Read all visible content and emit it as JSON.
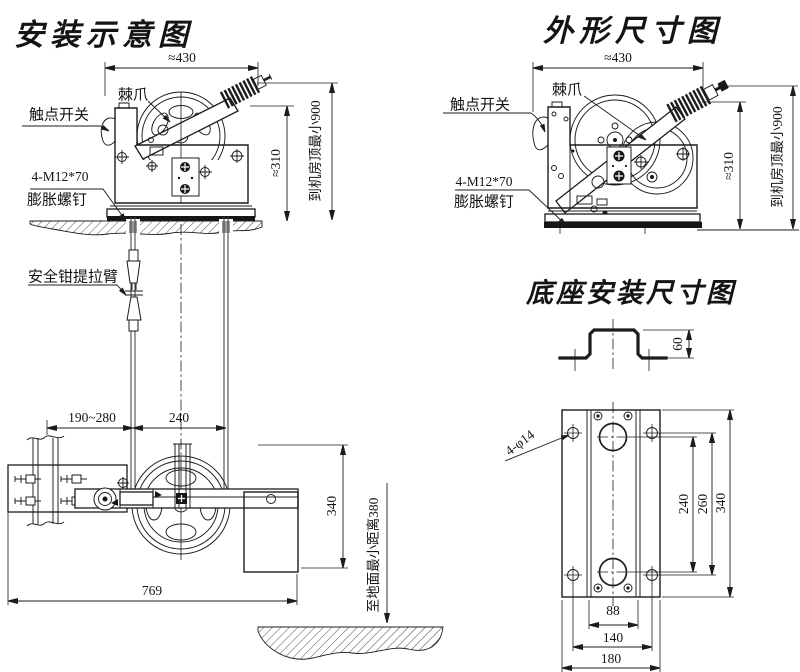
{
  "page": {
    "background": "#ffffff",
    "ink": "#1c1c1c"
  },
  "install_view": {
    "title": "安装示意图",
    "labels": {
      "pawl": "棘爪",
      "contact_switch": "触点开关",
      "bolt_spec": "4-M12*70",
      "expansion_bolt": "膨胀螺钉",
      "safety_gear_arm": "安全钳提拉臂",
      "to_machine_room_ceiling": "到机房顶最小900",
      "to_ground": "至地面最小距离380"
    },
    "dims": {
      "overall_width": "≈430",
      "overall_height": "≈310",
      "rail_to_rope": "190~280",
      "rope_spacing": "240",
      "tensioner_height": "340",
      "overall_reach": "769"
    }
  },
  "outline_view": {
    "title": "外形尺寸图",
    "labels": {
      "pawl": "棘爪",
      "contact_switch": "触点开关",
      "bolt_spec": "4-M12*70",
      "expansion_bolt": "膨胀螺钉",
      "to_machine_room_ceiling": "到机房顶最小900"
    },
    "dims": {
      "overall_width": "≈430",
      "overall_height": "≈310"
    }
  },
  "base_view": {
    "title": "底座安装尺寸图",
    "labels": {
      "mounting_holes": "4-φ14"
    },
    "dims": {
      "profile_height": "60",
      "circle_spacing": "240",
      "hole_spacing_v": "260",
      "plate_height": "340",
      "rail_spacing": "88",
      "hole_spacing_h": "140",
      "plate_width": "180"
    }
  }
}
